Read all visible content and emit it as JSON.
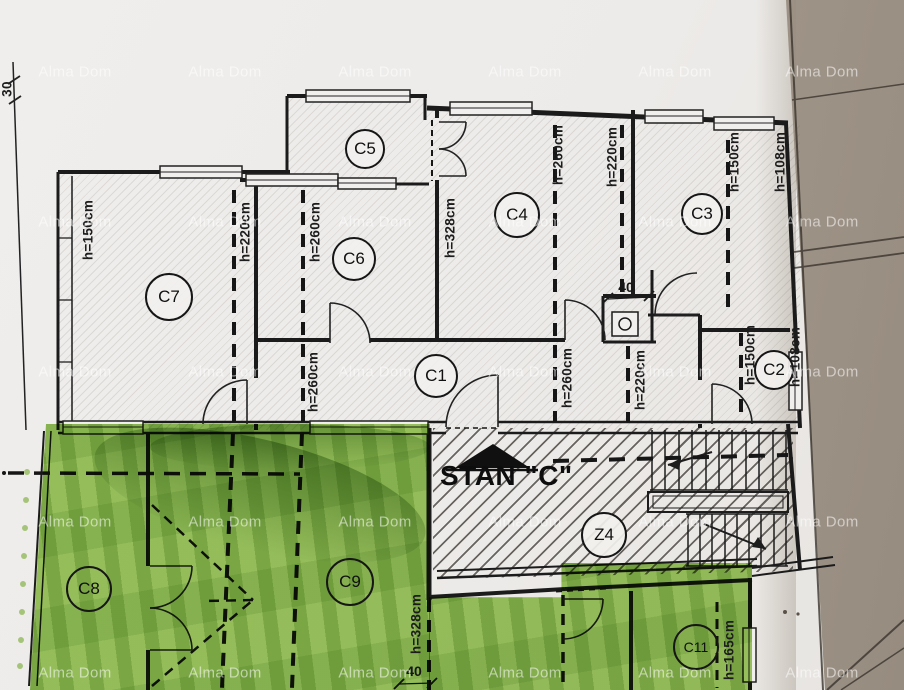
{
  "title_block": {
    "apartment_label": "STAN \"C\""
  },
  "watermark": {
    "text": "Alma Dom",
    "columns_x": [
      75,
      225,
      375,
      525,
      675,
      822
    ],
    "rows_y": [
      72,
      222,
      372,
      522,
      673
    ]
  },
  "rooms": [
    {
      "id": "C5",
      "x": 363,
      "y": 147,
      "r": 18,
      "zone": "white"
    },
    {
      "id": "C7",
      "x": 167,
      "y": 295,
      "r": 22,
      "zone": "white"
    },
    {
      "id": "C6",
      "x": 352,
      "y": 257,
      "r": 20,
      "zone": "white"
    },
    {
      "id": "C4",
      "x": 515,
      "y": 213,
      "r": 21,
      "zone": "white"
    },
    {
      "id": "C3",
      "x": 700,
      "y": 212,
      "r": 19,
      "zone": "white"
    },
    {
      "id": "C1",
      "x": 434,
      "y": 374,
      "r": 20,
      "zone": "white"
    },
    {
      "id": "C2",
      "x": 772,
      "y": 368,
      "r": 18,
      "zone": "white"
    },
    {
      "id": "Z4",
      "x": 602,
      "y": 533,
      "r": 21,
      "zone": "white"
    },
    {
      "id": "C8",
      "x": 87,
      "y": 587,
      "r": 21,
      "zone": "green"
    },
    {
      "id": "C9",
      "x": 348,
      "y": 580,
      "r": 22,
      "zone": "green"
    },
    {
      "id": "C11",
      "x": 694,
      "y": 645,
      "r": 21,
      "zone": "green",
      "small": true
    }
  ],
  "height_labels": [
    {
      "t": "h=150cm",
      "x": 88,
      "y": 230
    },
    {
      "t": "h=220cm",
      "x": 245,
      "y": 232
    },
    {
      "t": "h=260cm",
      "x": 315,
      "y": 232
    },
    {
      "t": "h=328cm",
      "x": 450,
      "y": 228
    },
    {
      "t": "h=260cm",
      "x": 558,
      "y": 155
    },
    {
      "t": "h=220cm",
      "x": 612,
      "y": 157
    },
    {
      "t": "h=150cm",
      "x": 734,
      "y": 162
    },
    {
      "t": "h=108cm",
      "x": 780,
      "y": 162
    },
    {
      "t": "h=260cm",
      "x": 313,
      "y": 382
    },
    {
      "t": "h=260cm",
      "x": 567,
      "y": 378
    },
    {
      "t": "h=220cm",
      "x": 640,
      "y": 380
    },
    {
      "t": "h=150cm",
      "x": 750,
      "y": 355
    },
    {
      "t": "h=108cm",
      "x": 795,
      "y": 357
    },
    {
      "t": "h=328cm",
      "x": 416,
      "y": 624
    },
    {
      "t": "h=165cm",
      "x": 729,
      "y": 650
    }
  ],
  "dim_labels": [
    {
      "t": "40",
      "x": 626,
      "y": 287,
      "rot": false
    },
    {
      "t": "40",
      "x": 414,
      "y": 671,
      "rot": false
    },
    {
      "t": "30",
      "x": 7,
      "y": 89,
      "rot": true
    }
  ],
  "colors": {
    "paper": "#EDEBE9",
    "page_shadow": "#A89D91",
    "ink": "#1B1B1B",
    "marker_green": "#8DC04B"
  }
}
